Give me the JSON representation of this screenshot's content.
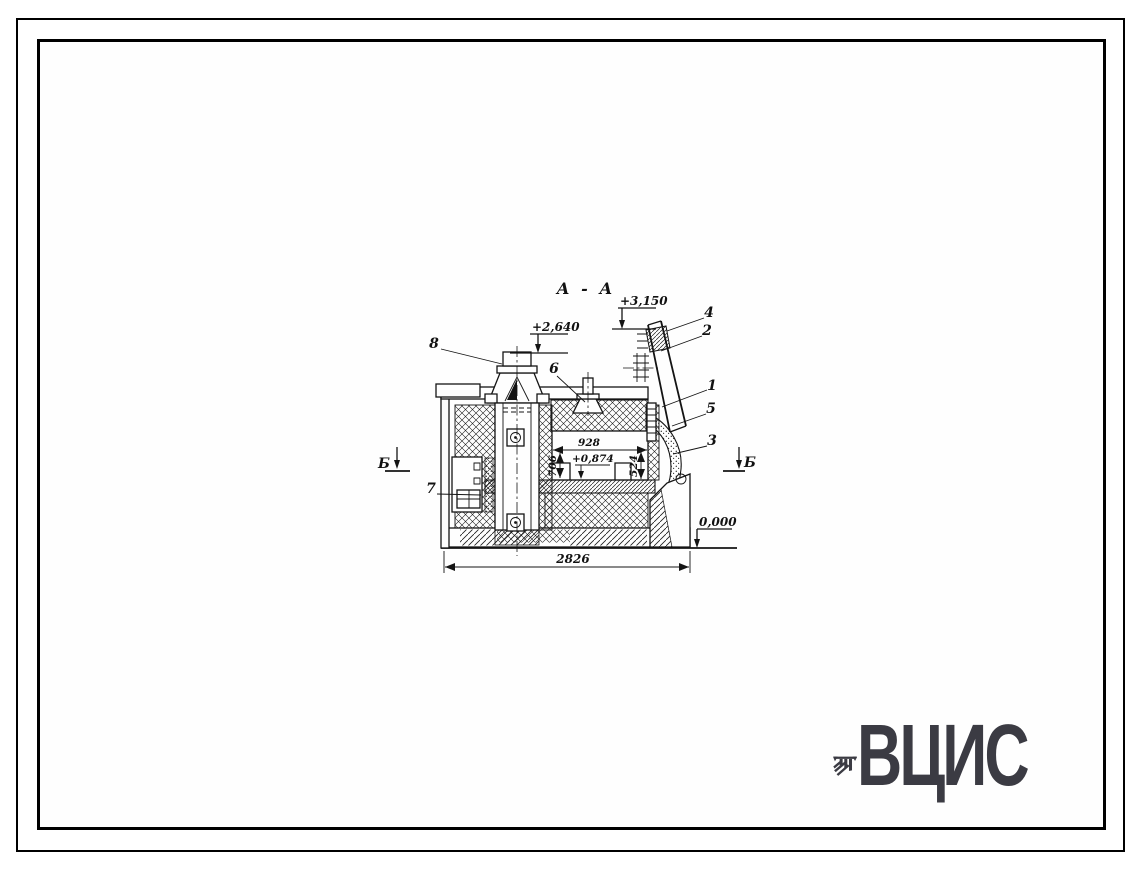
{
  "drawing": {
    "title": "А - А",
    "section_label_left": "Б",
    "section_label_right": "Б",
    "elevations": {
      "chute_top": "+3,150",
      "chimney_top": "+2,640",
      "hearth": "+0,874",
      "ground": "0,000"
    },
    "dimensions": {
      "overall_width": "2826",
      "chamber_width": "928",
      "chamber_height_left": "706",
      "chamber_height_right": "524"
    },
    "callouts": [
      "1",
      "2",
      "3",
      "4",
      "5",
      "6",
      "7",
      "8"
    ]
  },
  "logo": {
    "text": "ВЦИС",
    "color": "#3b3b43"
  }
}
